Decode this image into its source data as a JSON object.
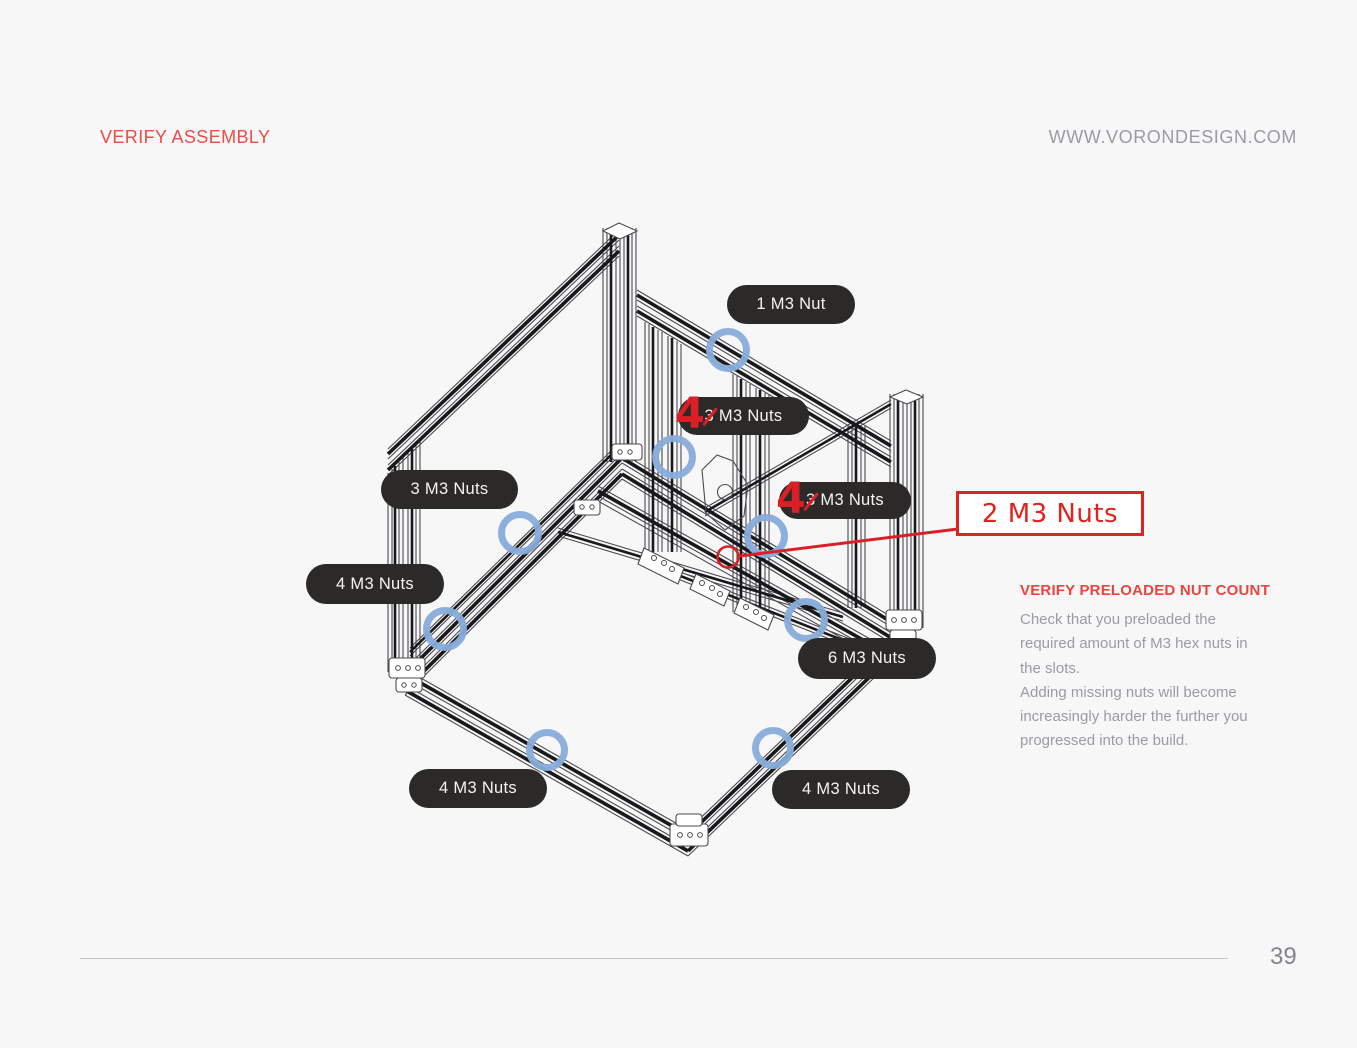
{
  "header": {
    "title": "VERIFY ASSEMBLY",
    "website": "WWW.VORONDESIGN.COM"
  },
  "illustration": {
    "description": "Isometric CAD wireframe of printer frame with preloaded hex nut locations circled",
    "marker_blue": "#88acda",
    "annotation_red": "#d92027"
  },
  "callouts": {
    "top": "1 M3 Nut",
    "gantry_left": {
      "correction": "4",
      "original": "3",
      "rest": " M3 Nuts"
    },
    "left_upper": "3 M3 Nuts",
    "gantry_right": {
      "correction": "4",
      "original": "3",
      "rest": " M3 Nuts"
    },
    "left_mid": "4 M3 Nuts",
    "right_mid": "6 M3 Nuts",
    "bottom_left": "4 M3 Nuts",
    "bottom_right": "4 M3 Nuts",
    "boxed": "2 M3 Nuts"
  },
  "note": {
    "title": "VERIFY PRELOADED NUT COUNT",
    "lines": [
      "Check that you preloaded the",
      "required amount of M3 hex nuts in",
      "the slots.",
      "Adding missing nuts will become",
      "increasingly harder the further you",
      "progressed into the build."
    ]
  },
  "footer": {
    "page_number": "39"
  }
}
